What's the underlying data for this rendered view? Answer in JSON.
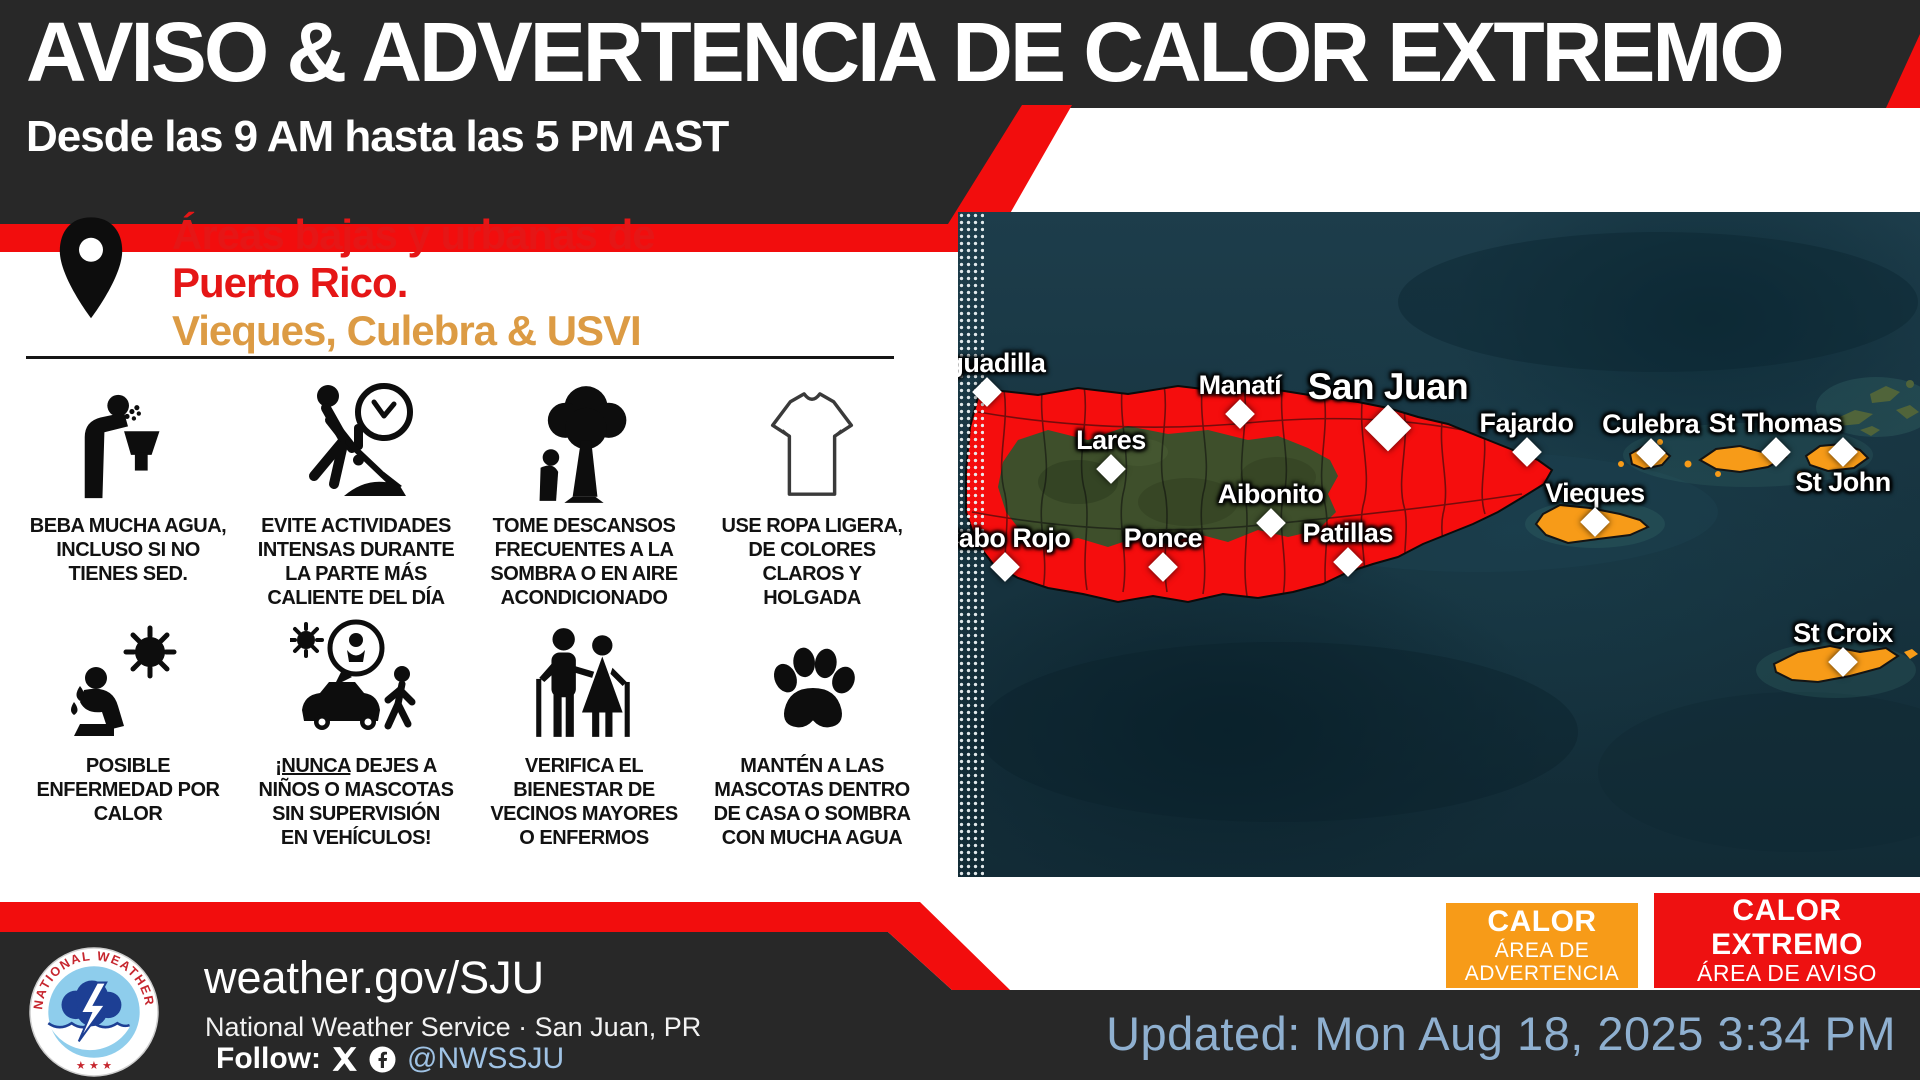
{
  "header": {
    "title": "AVISO & ADVERTENCIA DE CALOR EXTREMO",
    "subtitle": "Desde las 9 AM hasta las 5 PM AST"
  },
  "location": {
    "line1": "Áreas bajas y urbanas de",
    "line2": "Puerto Rico.",
    "line3": "Vieques, Culebra & USVI"
  },
  "tips": [
    {
      "icon": "drinking-fountain-icon",
      "text": "BEBA MUCHA AGUA, INCLUSO SI NO TIENES SED."
    },
    {
      "icon": "digging-worker-clock-icon",
      "text": "EVITE ACTIVIDADES INTENSAS DURANTE LA PARTE MÁS CALIENTE DEL DÍA"
    },
    {
      "icon": "tree-shade-icon",
      "text": "TOME DESCANSOS FRECUENTES A LA SOMBRA O EN AIRE ACONDICIONADO"
    },
    {
      "icon": "tshirt-icon",
      "text": "USE ROPA LIGERA, DE COLORES CLAROS Y HOLGADA"
    },
    {
      "icon": "heat-illness-icon",
      "text": "POSIBLE ENFERMEDAD POR CALOR"
    },
    {
      "icon": "car-child-pet-icon",
      "lead": "¡NUNCA",
      "rest": " DEJES A NIÑOS O MASCOTAS SIN SUPERVISIÓN EN VEHÍCULOS!"
    },
    {
      "icon": "elderly-couple-icon",
      "text": "VERIFICA EL BIENESTAR DE VECINOS MAYORES O ENFERMOS"
    },
    {
      "icon": "paw-icon",
      "text": "MANTÉN A LAS MASCOTAS DENTRO DE CASA O SOMBRA CON MUCHA AGUA"
    }
  ],
  "map": {
    "cities": [
      {
        "name": "Aguadilla",
        "x": 3.0,
        "y": 27.1
      },
      {
        "name": "Lares",
        "x": 15.9,
        "y": 38.6
      },
      {
        "name": "Manatí",
        "x": 29.3,
        "y": 30.4
      },
      {
        "name": "San Juan",
        "x": 44.7,
        "y": 32.5,
        "big": true
      },
      {
        "name": "Fajardo",
        "x": 59.1,
        "y": 36.1
      },
      {
        "name": "Cabo Rojo",
        "x": 4.9,
        "y": 53.4
      },
      {
        "name": "Ponce",
        "x": 21.3,
        "y": 53.4
      },
      {
        "name": "Aibonito",
        "x": 32.5,
        "y": 46.8
      },
      {
        "name": "Patillas",
        "x": 40.5,
        "y": 52.6
      },
      {
        "name": "Vieques",
        "x": 66.2,
        "y": 46.6
      },
      {
        "name": "Culebra",
        "x": 72.0,
        "y": 36.2
      },
      {
        "name": "St Thomas",
        "x": 85.0,
        "y": 36.1
      },
      {
        "name": "St John",
        "x": 92.0,
        "y": 36.1,
        "label_pos": "below"
      },
      {
        "name": "St Croix",
        "x": 92.0,
        "y": 67.7
      }
    ]
  },
  "legend": {
    "advisory": {
      "title": "CALOR",
      "sub1": "ÁREA DE",
      "sub2": "ADVERTENCIA",
      "color": "#F79B18"
    },
    "warning": {
      "title1": "CALOR",
      "title2": "EXTREMO",
      "sub": "ÁREA DE AVISO",
      "color": "#EE1111"
    }
  },
  "footer": {
    "website": "weather.gov/SJU",
    "org": "National Weather Service · San Juan, PR",
    "follow_label": "Follow:",
    "handle": "@NWSSJU",
    "logo_text": "NATIONAL WEATHER SERVICE"
  },
  "updated": {
    "text": "Updated: Mon Aug 18, 2025 3:34 PM"
  },
  "colors": {
    "accent_red": "#F20D0D",
    "accent_orange": "#F79B18",
    "charcoal": "#282828",
    "link_blue": "#9FC2E4",
    "updated_blue": "#8FB0D0"
  }
}
